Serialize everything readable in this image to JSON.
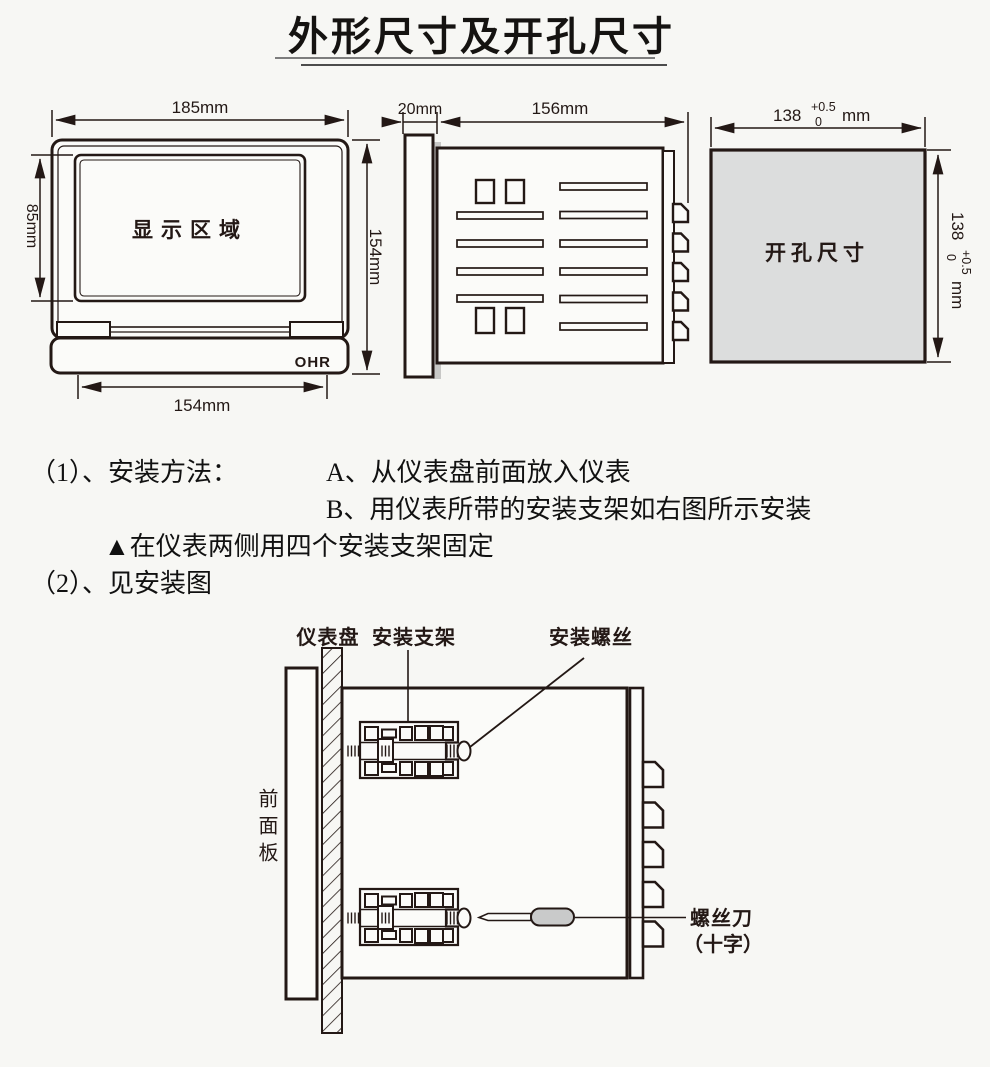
{
  "page": {
    "title": "外形尺寸及开孔尺寸",
    "colors": {
      "ink": "#231815",
      "cutout_fill": "#dcdddd",
      "handle_fill": "#c9caca"
    }
  },
  "front_view": {
    "width_dim": "185mm",
    "display_height_dim": "85mm",
    "height_dim": "154mm",
    "bottom_width_dim": "154mm",
    "display_label": "显示区域",
    "brand": "OHR"
  },
  "side_view": {
    "bezel_dim": "20mm",
    "depth_dim": "156mm"
  },
  "cutout": {
    "label": "开孔尺寸",
    "dim_value": "138",
    "tol_upper": "+0.5",
    "tol_lower": "0",
    "unit": "mm"
  },
  "notes": {
    "item1_prefix": "（1）、安装方法：",
    "step_a": "A、从仪表盘前面放入仪表",
    "step_b": "B、用仪表所带的安装支架如右图所示安装",
    "warning": "▲在仪表两侧用四个安装支架固定",
    "item2": "（2）、见安装图"
  },
  "install": {
    "panel_label": "仪表盘",
    "bracket_label": "安装支架",
    "screw_label": "安装螺丝",
    "front_panel_label": "前面板",
    "screwdriver_label": "螺丝刀",
    "screwdriver_type": "（十字）"
  }
}
